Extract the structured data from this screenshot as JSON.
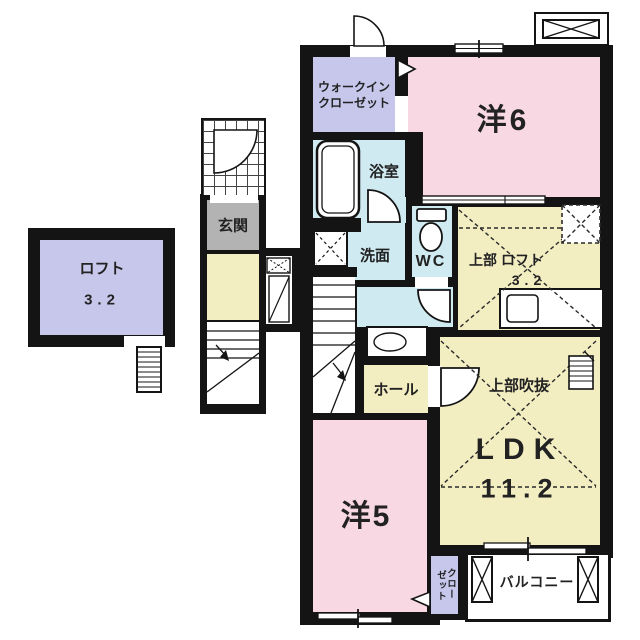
{
  "colors": {
    "wall": "#141414",
    "pink": "#f8d8e3",
    "lavender": "#c7c7ec",
    "blue": "#cfeaf1",
    "yellow": "#f3eec2",
    "gray": "#b3b3b3",
    "gridline": "#444444",
    "text": "#222222"
  },
  "rooms": {
    "loft": {
      "name": "ロフト",
      "size": "3.2"
    },
    "walk_in_closet": {
      "line1": "ウォークイン",
      "line2": "クローゼット"
    },
    "western6": {
      "name": "洋6"
    },
    "bath": {
      "name": "浴室"
    },
    "washroom": {
      "name": "洗面"
    },
    "wc": {
      "name": "WC"
    },
    "entrance": {
      "name": "玄関"
    },
    "upper_loft": {
      "name": "上部 ロフト",
      "size": "3.2"
    },
    "hall": {
      "name": "ホール"
    },
    "void": {
      "name": "上部吹抜"
    },
    "ldk": {
      "name": "LDK",
      "size": "11.2"
    },
    "western5": {
      "name": "洋5"
    },
    "closet": {
      "col1": "クロー",
      "col2": "ゼット"
    },
    "balcony": {
      "name": "バルコニー"
    }
  }
}
